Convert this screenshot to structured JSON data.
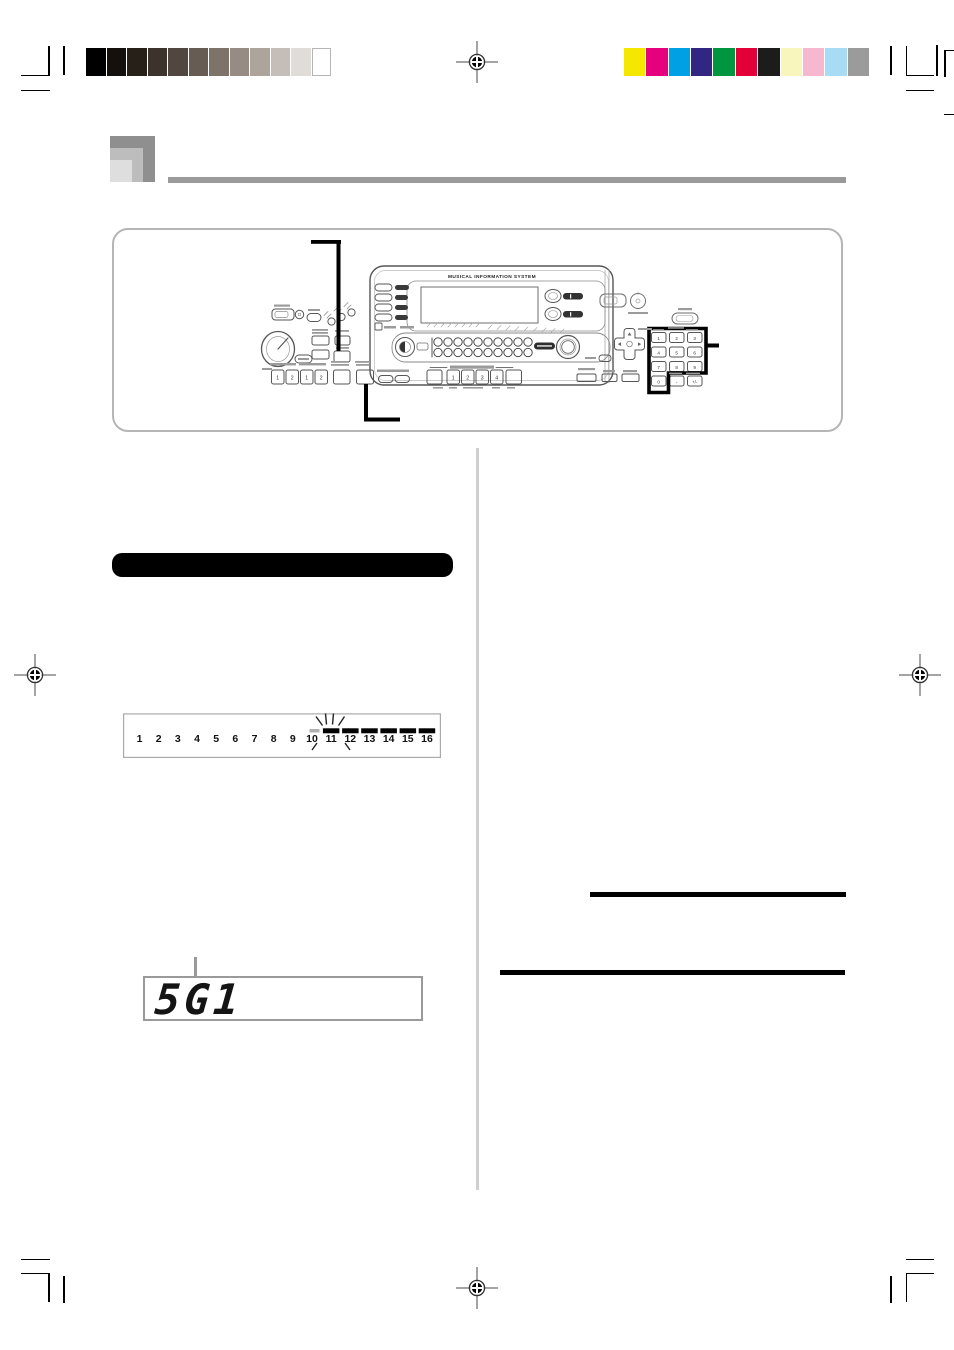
{
  "document": {
    "console_brand": "MUSICAL INFORMATION SYSTEM",
    "lcd": {
      "value": "5G1"
    },
    "section_bar_label": "",
    "track_strip": {
      "numbers": [
        "1",
        "2",
        "3",
        "4",
        "5",
        "6",
        "7",
        "8",
        "9",
        "10",
        "11",
        "12",
        "13",
        "14",
        "15",
        "16"
      ],
      "bars_over": [
        "11",
        "12",
        "13",
        "14",
        "15",
        "16"
      ],
      "flashing": "11"
    },
    "panel": {
      "keypad_keys": [
        "1",
        "2",
        "3",
        "4",
        "5",
        "6",
        "7",
        "8",
        "9",
        "0",
        "-",
        "+/-"
      ],
      "left_button_numerals": [
        "1",
        "2",
        "1",
        "2"
      ],
      "variation_numerals": [
        "1",
        "2",
        "3",
        "4"
      ]
    },
    "print_marks": {
      "grayscale_bar": [
        "#000000",
        "#14100e",
        "#262019",
        "#3c332c",
        "#514740",
        "#675c53",
        "#7e7369",
        "#968c83",
        "#ada49c",
        "#c5beb8",
        "#e0dcd8",
        "#ffffff"
      ],
      "color_bar": [
        "#f6e700",
        "#e5007d",
        "#00a0e4",
        "#312782",
        "#009640",
        "#e30039",
        "#1c1c1a",
        "#f8f5bd",
        "#f6b8d0",
        "#a8dcf4",
        "#9c9b9b"
      ]
    }
  }
}
